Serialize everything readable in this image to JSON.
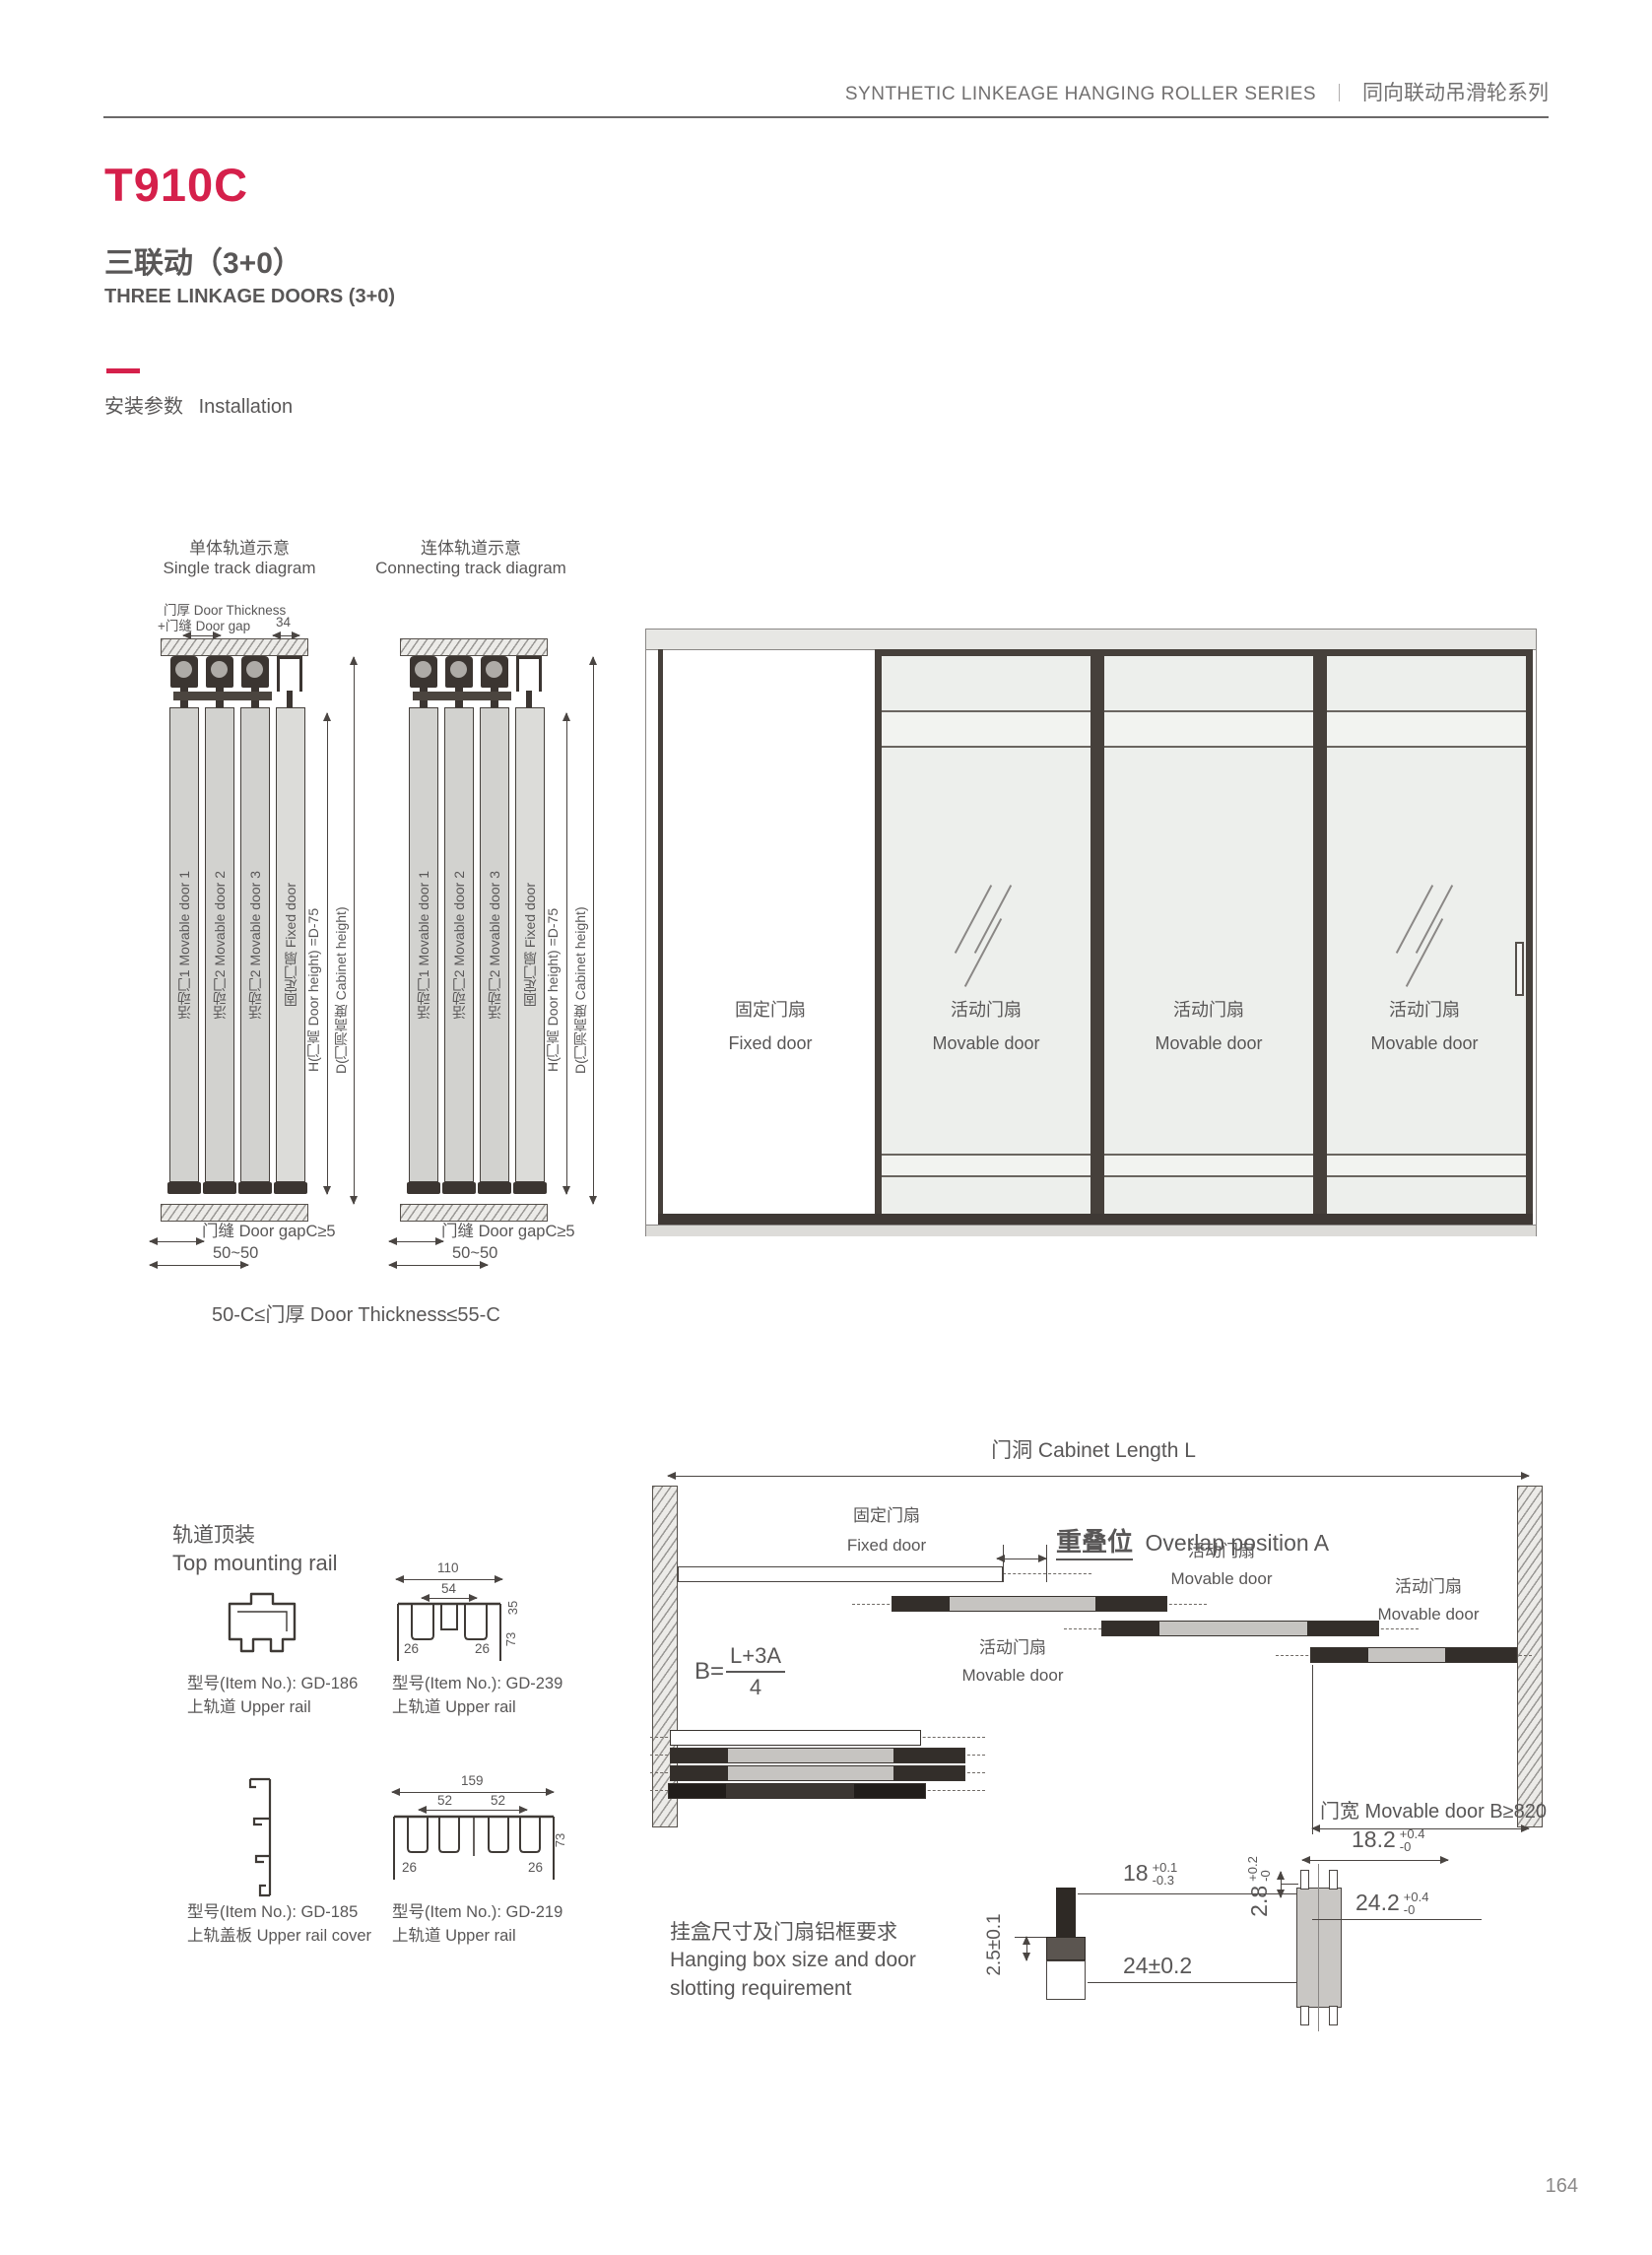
{
  "colors": {
    "accent": "#d5204b",
    "text": "#595757",
    "line": "#4a4542"
  },
  "header": {
    "series_en": "SYNTHETIC LINKEAGE HANGING ROLLER SERIES",
    "divider": "｜",
    "series_cn": "同向联动吊滑轮系列"
  },
  "title": {
    "model": "T910C",
    "sub_cn": "三联动（3+0）",
    "sub_en": "THREE LINKAGE DOORS (3+0)"
  },
  "install": {
    "cn": "安装参数",
    "en": "Installation"
  },
  "track": {
    "single_cn": "单体轨道示意",
    "single_en": "Single track diagram",
    "conn_cn": "连体轨道示意",
    "conn_en": "Connecting track diagram",
    "thickness_label": "门厚 Door Thickness",
    "gap_label": "+门缝 Door gap",
    "dim_34": "34",
    "doors": [
      "活动门1 Movable door 1",
      "活动门2 Movable door 2",
      "活动门2 Movable door 3",
      "固定门扇 Fixed door"
    ],
    "dim_h": "H(门高 Door height) =D-75",
    "dim_d": "D(门洞高度 Cabinet height)",
    "gap_bottom": "门缝 Door gapC≥5",
    "dim_5050": "50~50",
    "note": "50-C≤门厚 Door Thickness≤55-C"
  },
  "cabinet": {
    "fixed_cn": "固定门扇",
    "fixed_en": "Fixed door",
    "mov_cn": "活动门扇",
    "mov_en": "Movable door"
  },
  "rails": {
    "heading_cn": "轨道顶装",
    "heading_en": "Top mounting rail",
    "gd186": {
      "no": "型号(Item No.): GD-186",
      "name": "上轨道 Upper rail"
    },
    "gd239": {
      "no": "型号(Item No.): GD-239",
      "name": "上轨道 Upper rail",
      "d110": "110",
      "d54": "54",
      "d26a": "26",
      "d26b": "26",
      "d35": "35",
      "d73": "73"
    },
    "gd185": {
      "no": "型号(Item No.): GD-185",
      "name": "上轨盖板 Upper rail cover"
    },
    "gd219": {
      "no": "型号(Item No.): GD-219",
      "name": "上轨道 Upper rail",
      "d159": "159",
      "d52a": "52",
      "d52b": "52",
      "d26a": "26",
      "d26b": "26",
      "d73": "73"
    }
  },
  "layout": {
    "length": "门洞 Cabinet Length L",
    "overlap_cn": "重叠位",
    "overlap_en": "Overlap position A",
    "formula_b": "B=",
    "formula_num": "L+3A",
    "formula_den": "4",
    "width_note": "门宽 Movable door B≥820"
  },
  "hanging": {
    "note_cn": "挂盒尺寸及门扇铝框要求",
    "note_en1": "Hanging box size and door",
    "note_en2": "slotting requirement",
    "d25": "2.5±0.1",
    "d24": "24±0.2",
    "d18": "18",
    "d18u": "+0.1",
    "d18d": "-0.3",
    "d28": "2.8",
    "d28u": "+0.2",
    "d28d": "-0",
    "d182": "18.2",
    "d182u": "+0.4",
    "d182d": "-0",
    "d242": "24.2",
    "d242u": "+0.4",
    "d242d": "-0"
  },
  "footer": {
    "page": "164"
  }
}
